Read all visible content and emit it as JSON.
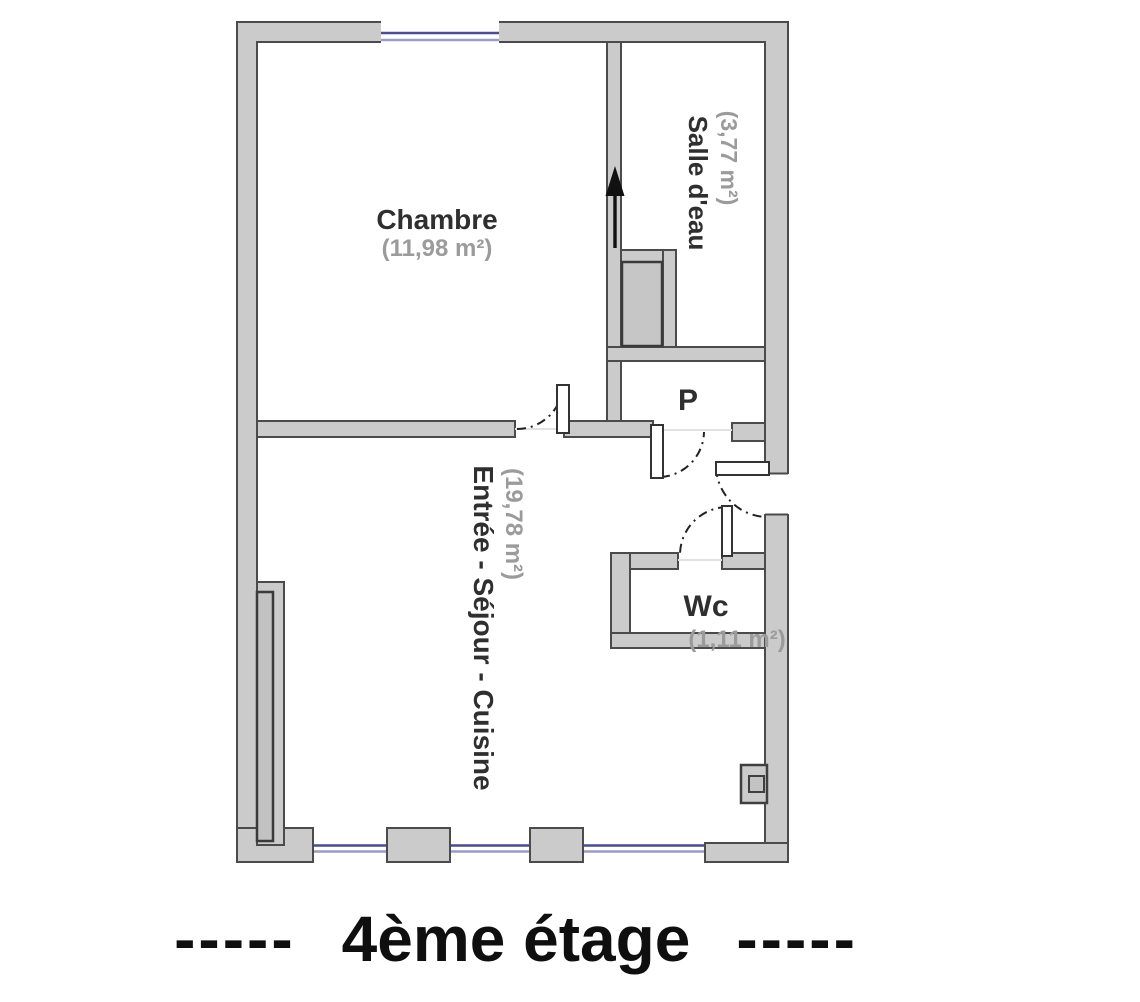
{
  "floor_plan": {
    "rooms": {
      "chambre": {
        "name": "Chambre",
        "area": "(11,98 m²)"
      },
      "salle_deau": {
        "name": "Salle d'eau",
        "area": "(3,77 m²)"
      },
      "placard": {
        "name": "P"
      },
      "sejour": {
        "name": "Entrée - Séjour - Cuisine",
        "area": "(19,78 m²)"
      },
      "wc": {
        "name": "Wc",
        "area": "(1,11 m²)"
      }
    },
    "caption": {
      "left_dashes": "-----",
      "title": "4ème étage",
      "right_dashes": "-----"
    },
    "colors": {
      "wall_fill": "#cbcbcb",
      "wall_stroke": "#4b4b4b",
      "window_line_dark": "#4a4a96",
      "window_line_light": "#9a9acc",
      "room_label": "#2f2f2f",
      "area_label": "#9b9b9b",
      "door_arc": "#222222",
      "north_arrow": "#111111"
    }
  }
}
